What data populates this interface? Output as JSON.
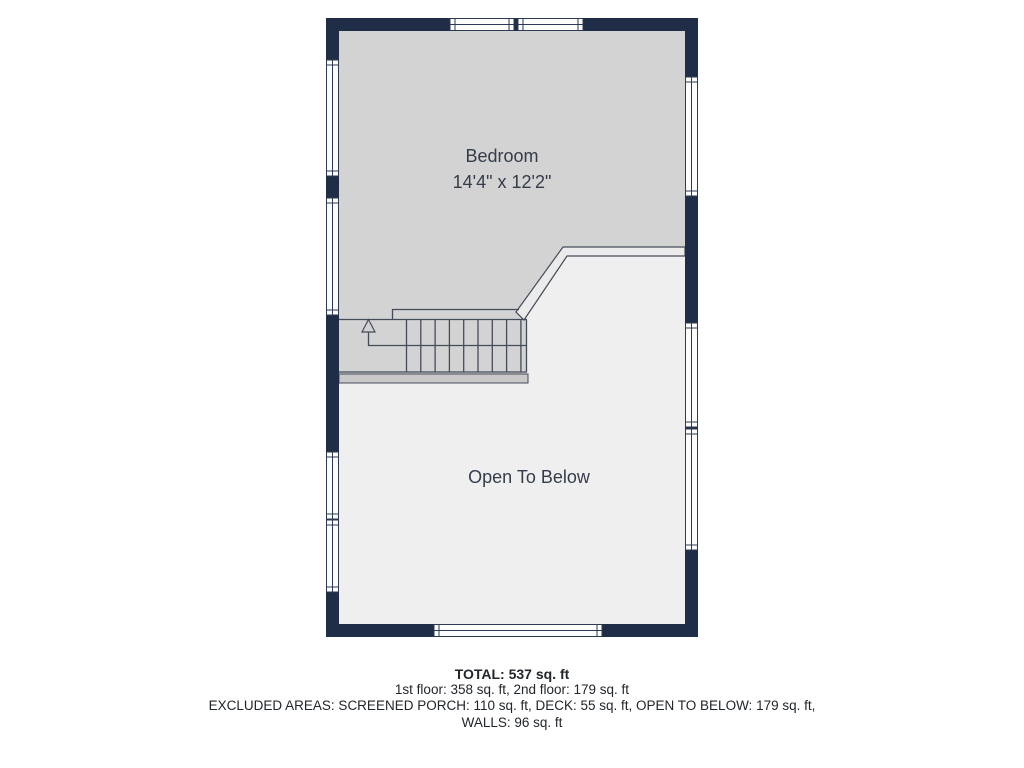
{
  "floor_plan": {
    "rooms": [
      {
        "label": "Bedroom",
        "dimensions": "14'4\" x 12'2\""
      },
      {
        "label": "Open To Below",
        "dimensions": ""
      }
    ],
    "stairs": {
      "direction": "up",
      "icon": "up-arrow-icon"
    },
    "features": [
      "staircase",
      "railing",
      "windows"
    ]
  },
  "summary": {
    "total": "TOTAL: 537 sq. ft",
    "floors": "1st floor: 358 sq. ft, 2nd floor: 179 sq. ft",
    "excluded_areas": "EXCLUDED AREAS: SCREENED PORCH: 110 sq. ft, DECK: 55 sq. ft, OPEN TO BELOW: 179 sq. ft,",
    "walls": "WALLS: 96 sq. ft"
  },
  "colors": {
    "wall": "#1f2d47",
    "bedroom": "#d3d3d3",
    "open": "#efefef",
    "rail": "#ebebeb",
    "bar": "#c9c9c9",
    "line": "#454c59",
    "window": "#fdfdfd",
    "winline": "#2c3a52",
    "label": "#343c4a",
    "text": "#21262b"
  }
}
